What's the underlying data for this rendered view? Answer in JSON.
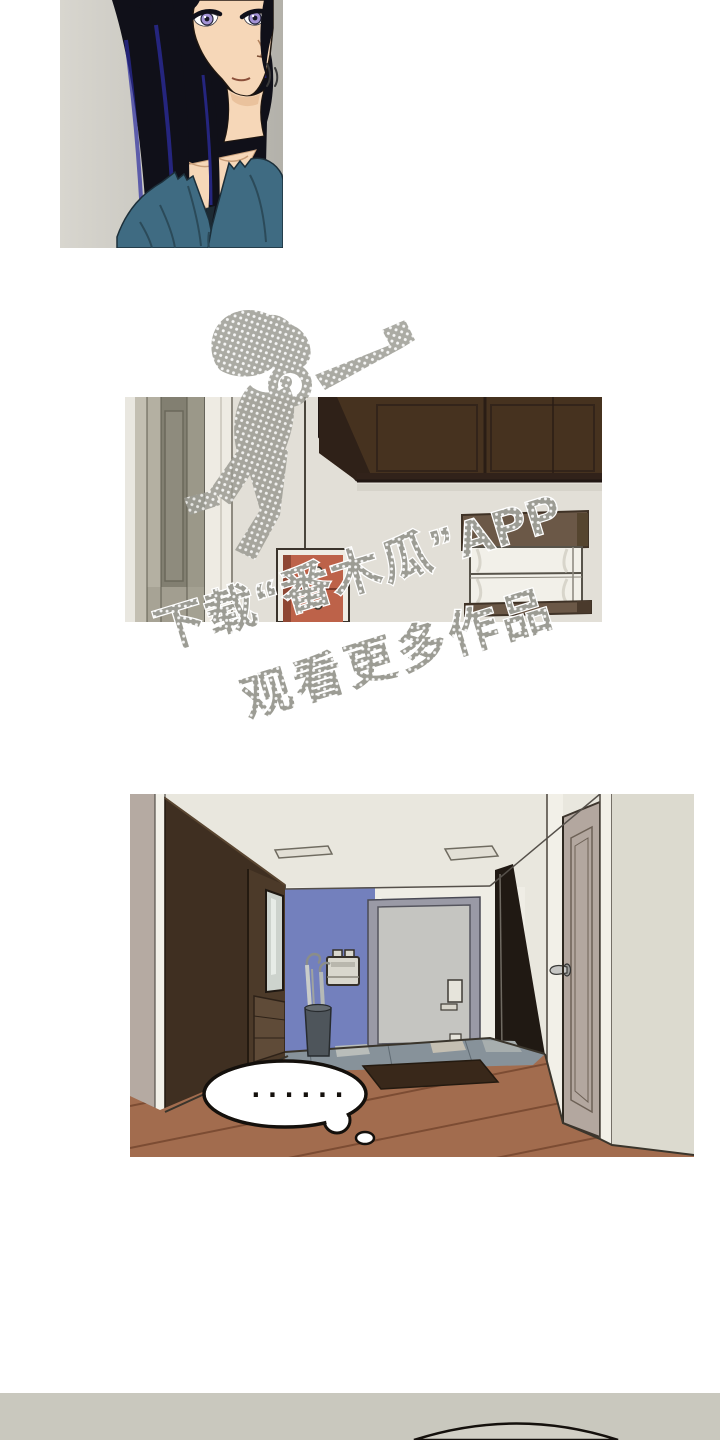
{
  "page": {
    "kind": "webtoon-comic-page",
    "background": "#ffffff"
  },
  "watermark": {
    "line1": "下载“番木瓜”APP",
    "line2": "观看更多作品"
  },
  "bubble": {
    "text": "......"
  },
  "palette": {
    "paper": "#ffffff",
    "ink": "#14100c",
    "bar": "#c9c8be",
    "barArc": "#d2d0c6",
    "cream": "#e2dfd7",
    "ceiling": "#e9e7de",
    "wallLight": "#efede5",
    "outerWall": "#dcdacf",
    "hair": "#101019",
    "hairBlue": "#2c2ca0",
    "skin": "#f6d7b8",
    "skinShade": "#e7bd96",
    "shirt": "#3f6b82",
    "shirtFold": "#2b4a59",
    "iris": "#a393d6",
    "wood": "#a26c4e",
    "woodLine": "#7c4c33",
    "tile": "#87929a",
    "tileLine": "#5f6a72",
    "mat": "#39281a",
    "purple": "#7380bd",
    "wardrobe": "#3f2f21",
    "wardrobeFace": "#4c3a29",
    "mauve": "#b5aaa2",
    "doorSlab": "#c5c5c1",
    "doorFrame": "#9a9aa6",
    "rightDoor": "#b3a79f",
    "casing": "#f2f0e8",
    "redCab": "#bd6249",
    "redCabSide": "#8f4733",
    "redCabFrame": "#efece3",
    "valance": "#6b5847",
    "windowWhite": "#f2f0e9",
    "brownDark": "#46321f",
    "watermark": "#9c9c94",
    "mirror": "#cdd3cd"
  }
}
